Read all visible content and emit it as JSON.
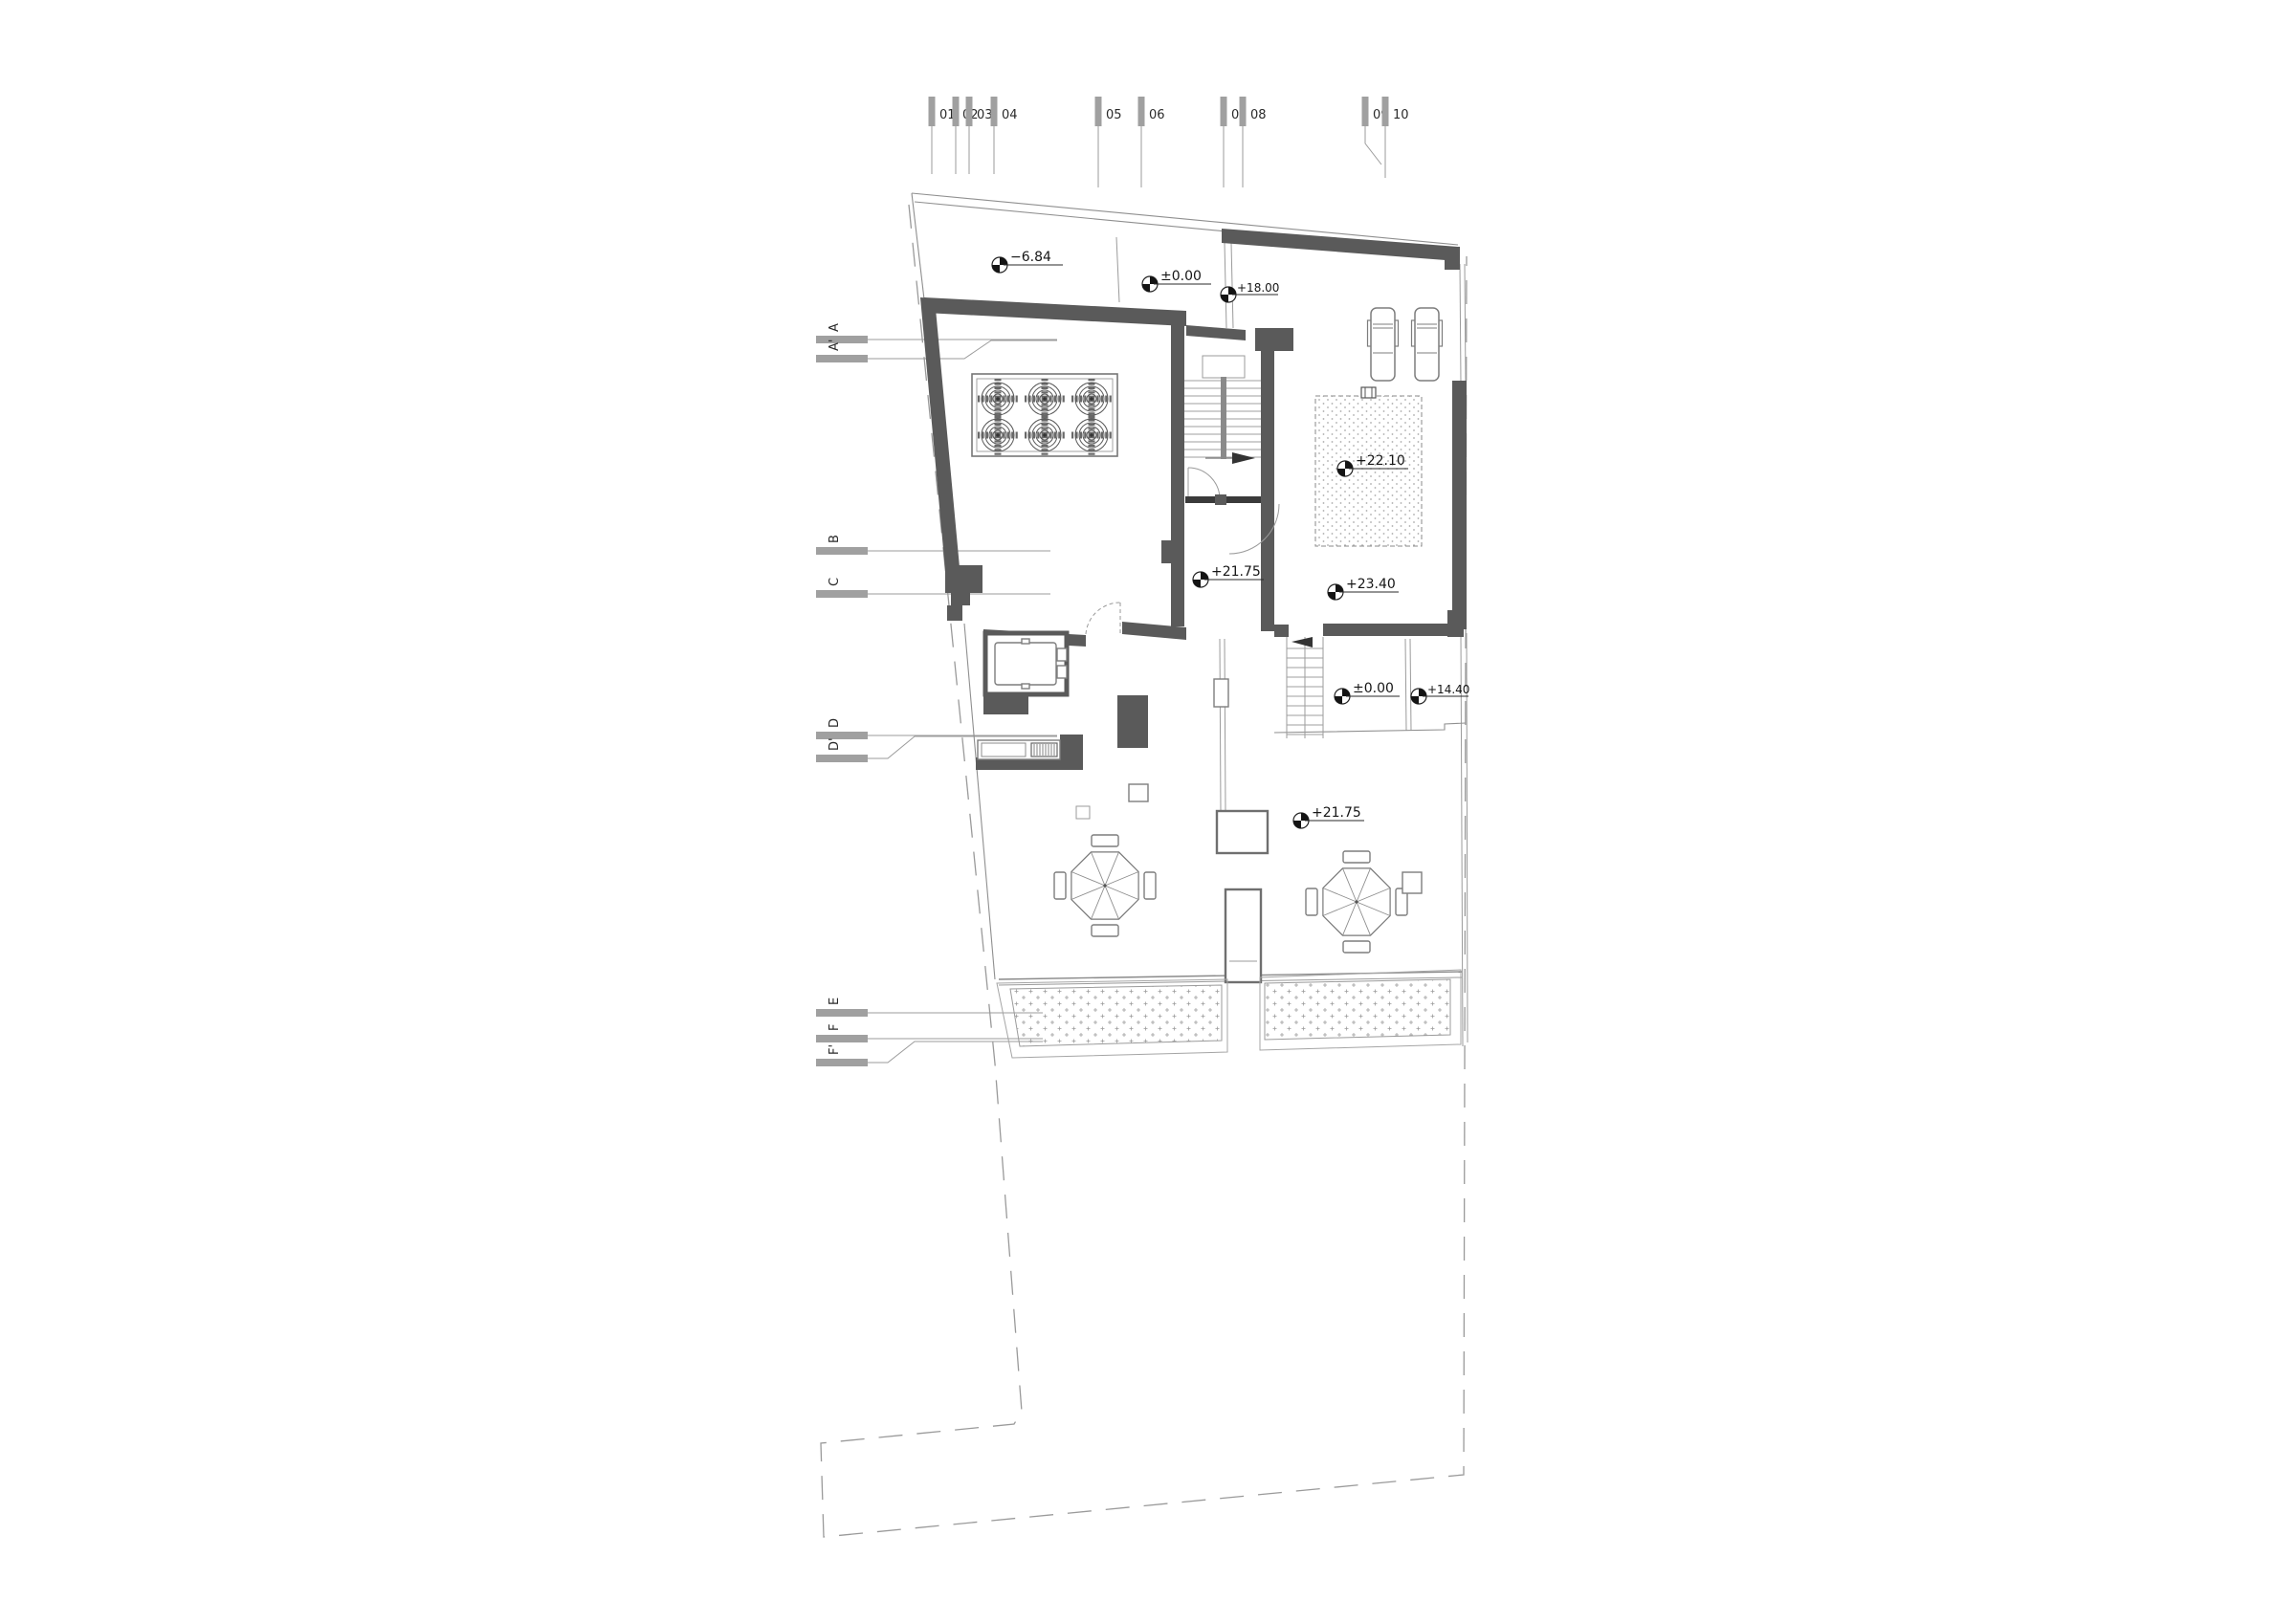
{
  "drawing_type": "roof-terrace-floor-plan",
  "colors": {
    "wall": "#5a5a5a",
    "thin_line": "#9b9b9b",
    "boundary_dash": "#9a9a9a",
    "grid_bar": "#a0a0a0",
    "text": "#1a1a1a"
  },
  "grid_columns": [
    {
      "label": "01"
    },
    {
      "label": "02"
    },
    {
      "label": "03"
    },
    {
      "label": "04"
    },
    {
      "label": "05"
    },
    {
      "label": "06"
    },
    {
      "label": "07"
    },
    {
      "label": "08"
    },
    {
      "label": "09"
    },
    {
      "label": "10"
    }
  ],
  "section_markers": [
    {
      "label": "A"
    },
    {
      "label": "A'"
    },
    {
      "label": "B"
    },
    {
      "label": "C"
    },
    {
      "label": "D"
    },
    {
      "label": "D'"
    },
    {
      "label": "E"
    },
    {
      "label": "F"
    },
    {
      "label": "F'"
    }
  ],
  "elevation_markers": [
    {
      "value": "−6.84"
    },
    {
      "value": "±0.00"
    },
    {
      "value": "+18.00"
    },
    {
      "value": "+22.10"
    },
    {
      "value": "+23.40"
    },
    {
      "value": "+21.75"
    },
    {
      "value": "±0.00"
    },
    {
      "value": "+14.40"
    },
    {
      "value": "+21.75"
    }
  ]
}
